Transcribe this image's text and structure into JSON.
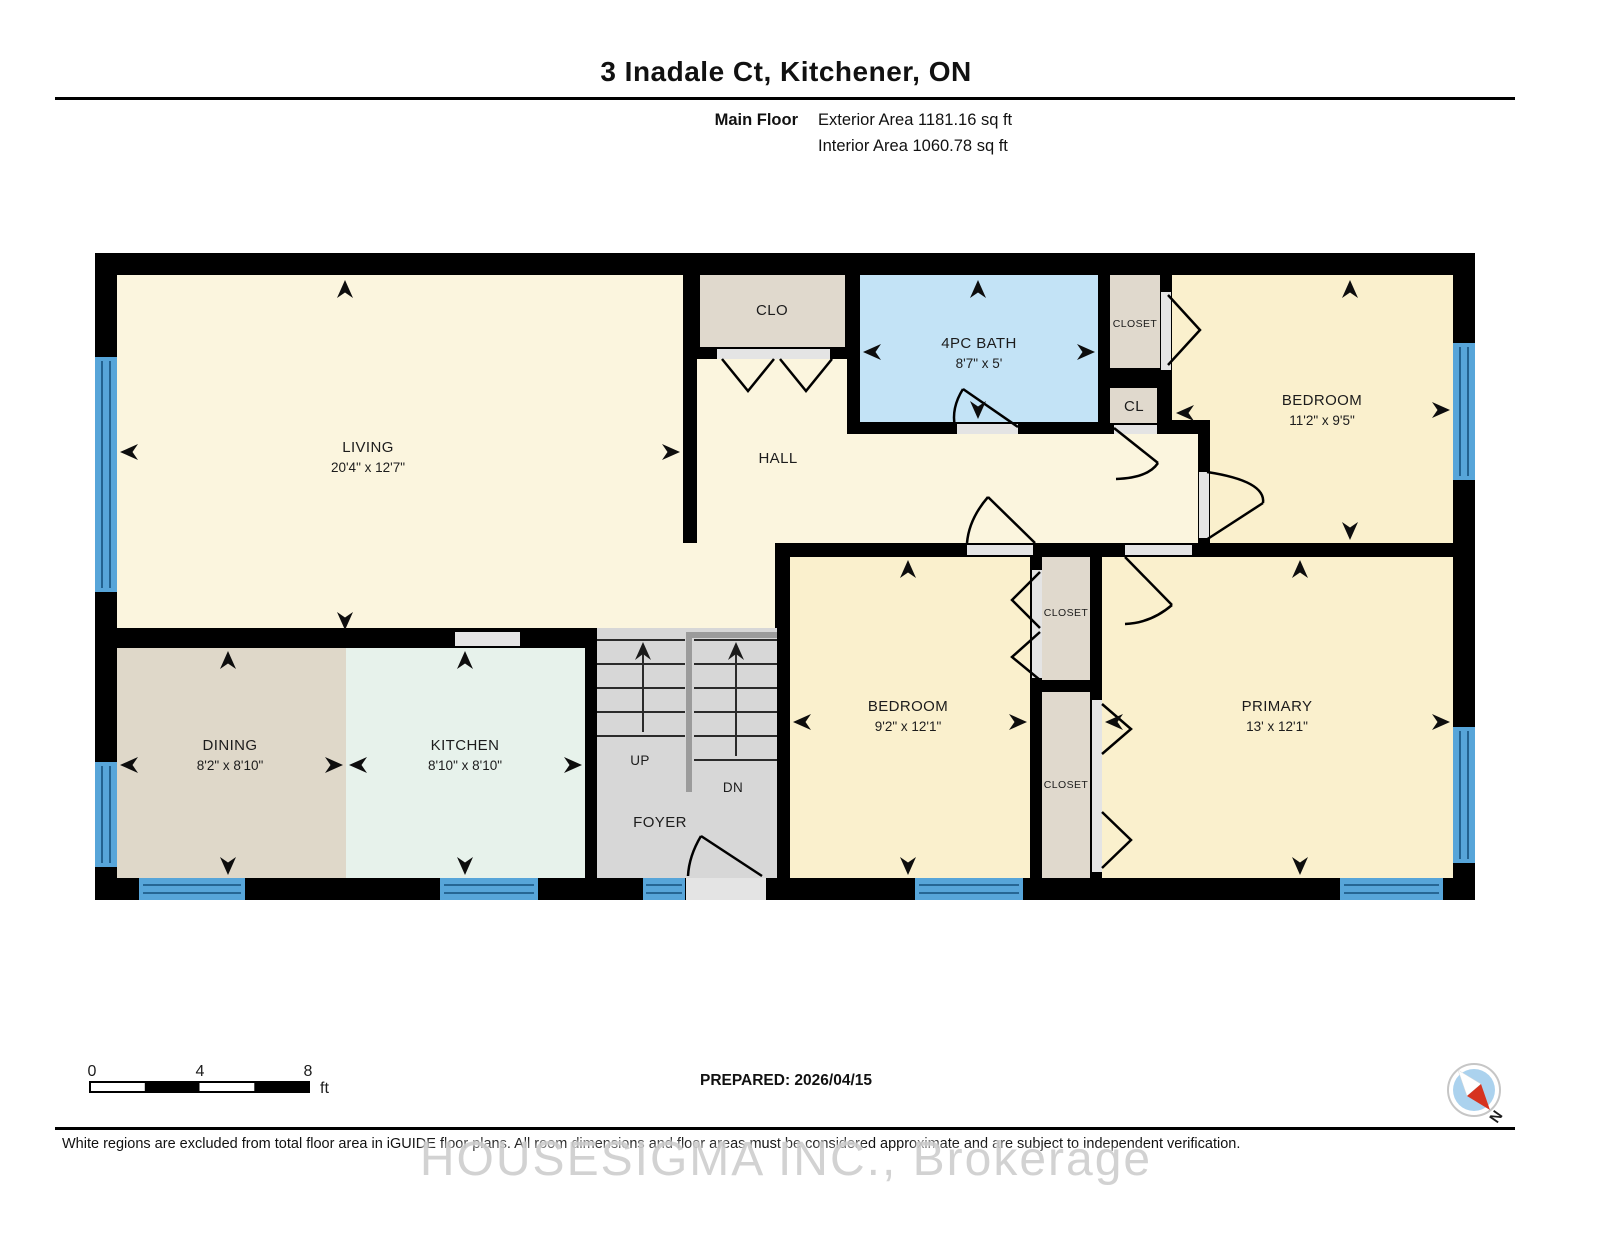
{
  "header": {
    "title": "3 Inadale Ct, Kitchener, ON",
    "floor_label": "Main Floor",
    "exterior_area": "Exterior Area 1181.16 sq ft",
    "interior_area": "Interior Area 1060.78 sq ft"
  },
  "rooms": {
    "living": {
      "name": "LIVING",
      "dims": "20'4\" x 12'7\""
    },
    "clo": {
      "name": "CLO"
    },
    "bath": {
      "name": "4PC BATH",
      "dims": "8'7\" x 5'"
    },
    "closet_top": {
      "name": "CLOSET"
    },
    "cl": {
      "name": "CL"
    },
    "bedroom2": {
      "name": "BEDROOM",
      "dims": "11'2\" x 9'5\""
    },
    "hall": {
      "name": "HALL"
    },
    "dining": {
      "name": "DINING",
      "dims": "8'2\" x 8'10\""
    },
    "kitchen": {
      "name": "KITCHEN",
      "dims": "8'10\" x 8'10\""
    },
    "stairs": {
      "up": "UP",
      "down": "DN"
    },
    "foyer": {
      "name": "FOYER"
    },
    "bedroom3": {
      "name": "BEDROOM",
      "dims": "9'2\" x 12'1\""
    },
    "closet_mid_upper": {
      "name": "CLOSET"
    },
    "closet_mid_lower": {
      "name": "CLOSET"
    },
    "primary": {
      "name": "PRIMARY",
      "dims": "13' x 12'1\""
    }
  },
  "scale_bar": {
    "ticks": [
      "0",
      "4",
      "8"
    ],
    "unit": "ft"
  },
  "footer": {
    "prepared": "PREPARED: 2026/04/15",
    "disclaimer": "White regions are excluded from total floor area in iGUIDE floor plans. All room dimensions and floor areas must be considered approximate and are subject to independent verification.",
    "watermark": "HOUSESIGMA INC., Brokerage"
  },
  "compass": {
    "label": "N"
  },
  "colors": {
    "wall": "#000000",
    "room_cream": "#FBF5DE",
    "room_warm_yellow": "#FAF0CD",
    "room_tan": "#DFD8C9",
    "room_mint": "#E7F2EB",
    "room_bath_blue": "#C3E3F6",
    "stairs_gray": "#D7D7D7",
    "window_blue": "#57A5D9",
    "compass_blue": "#ABD2EE",
    "compass_red": "#D6331F",
    "watermark_gray": "#CFCFCF"
  }
}
